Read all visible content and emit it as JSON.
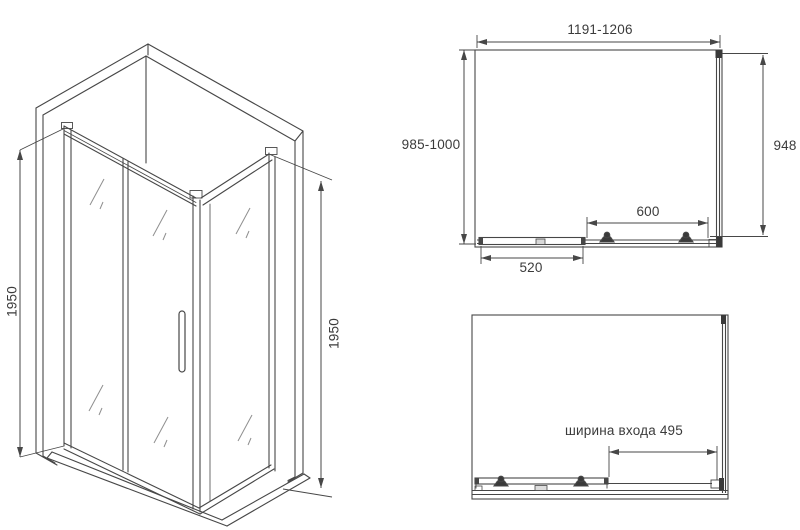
{
  "title": "Shower enclosure technical drawing",
  "views": {
    "isometric": {
      "height_left": "1950",
      "height_right": "1950"
    },
    "plan_closed": {
      "width_range": "1191-1206",
      "depth_range": "985-1000",
      "side_depth": "948",
      "door_width": "600",
      "fixed_panel_width": "520"
    },
    "plan_open": {
      "entrance_width": "ширина входа 495"
    }
  },
  "colors": {
    "line": "#474747",
    "text": "#3b3b3b",
    "background": "#ffffff"
  }
}
